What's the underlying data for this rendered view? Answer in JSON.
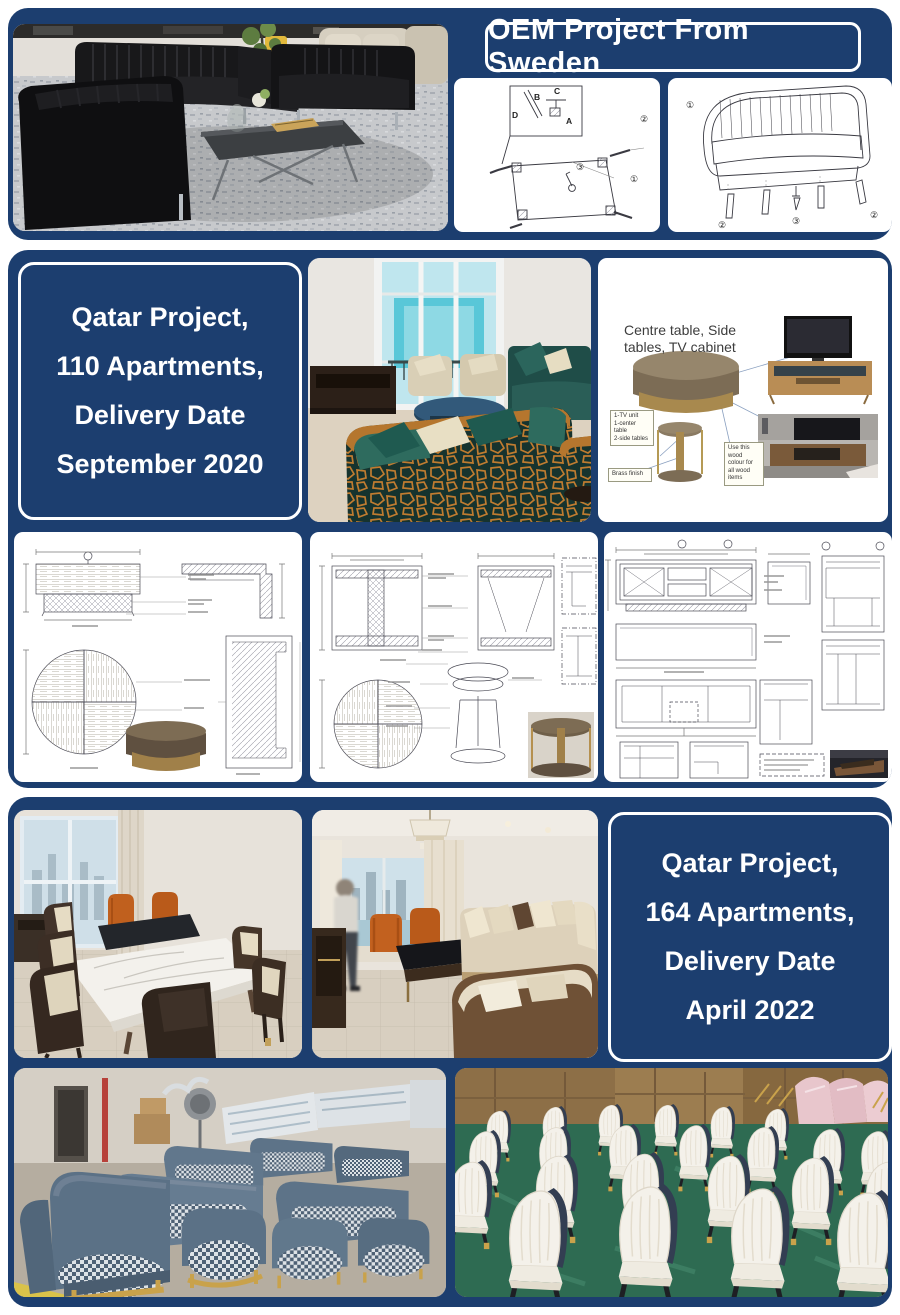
{
  "page": {
    "bg": "#ffffff",
    "panel_blue": "#1c3e6f"
  },
  "section_oem": {
    "title": "OEM Project From Sweden",
    "assembly_letters": {
      "b": "B",
      "c": "C",
      "d": "D",
      "a": "A"
    },
    "step_numbers": {
      "n1": "①",
      "n2": "②",
      "n3": "③"
    }
  },
  "section_qatar_110": {
    "card_lines": [
      "Qatar Project,",
      "110 Apartments,",
      "Delivery Date",
      "September 2020"
    ],
    "diagram": {
      "title": "Centre table, Side tables, TV cabinet",
      "note_items": [
        "1-TV unit",
        "1-center table",
        "2-side tables"
      ],
      "note_brass": "Brass finish",
      "note_wood": "Use this wood colour for all wood items"
    }
  },
  "section_qatar_164": {
    "card_lines": [
      "Qatar Project,",
      "164 Apartments,",
      "Delivery Date",
      "April 2022"
    ]
  }
}
